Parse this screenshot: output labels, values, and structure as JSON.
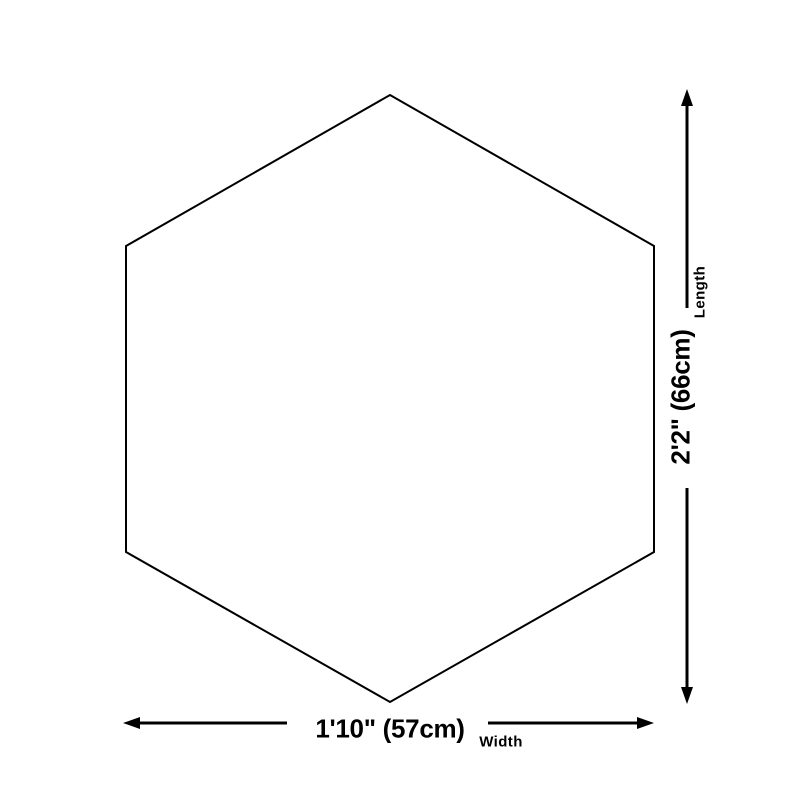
{
  "page": {
    "background_color": "#ffffff",
    "foreground_color": "#000000"
  },
  "diagram": {
    "shape": "hexagon",
    "outline_color": "#000000",
    "arrow_color": "#000000",
    "dimensions": {
      "length": {
        "value": "2'2\" (66cm)",
        "label": "Length"
      },
      "width": {
        "value": "1'10\" (57cm)",
        "label": "Width"
      }
    }
  }
}
